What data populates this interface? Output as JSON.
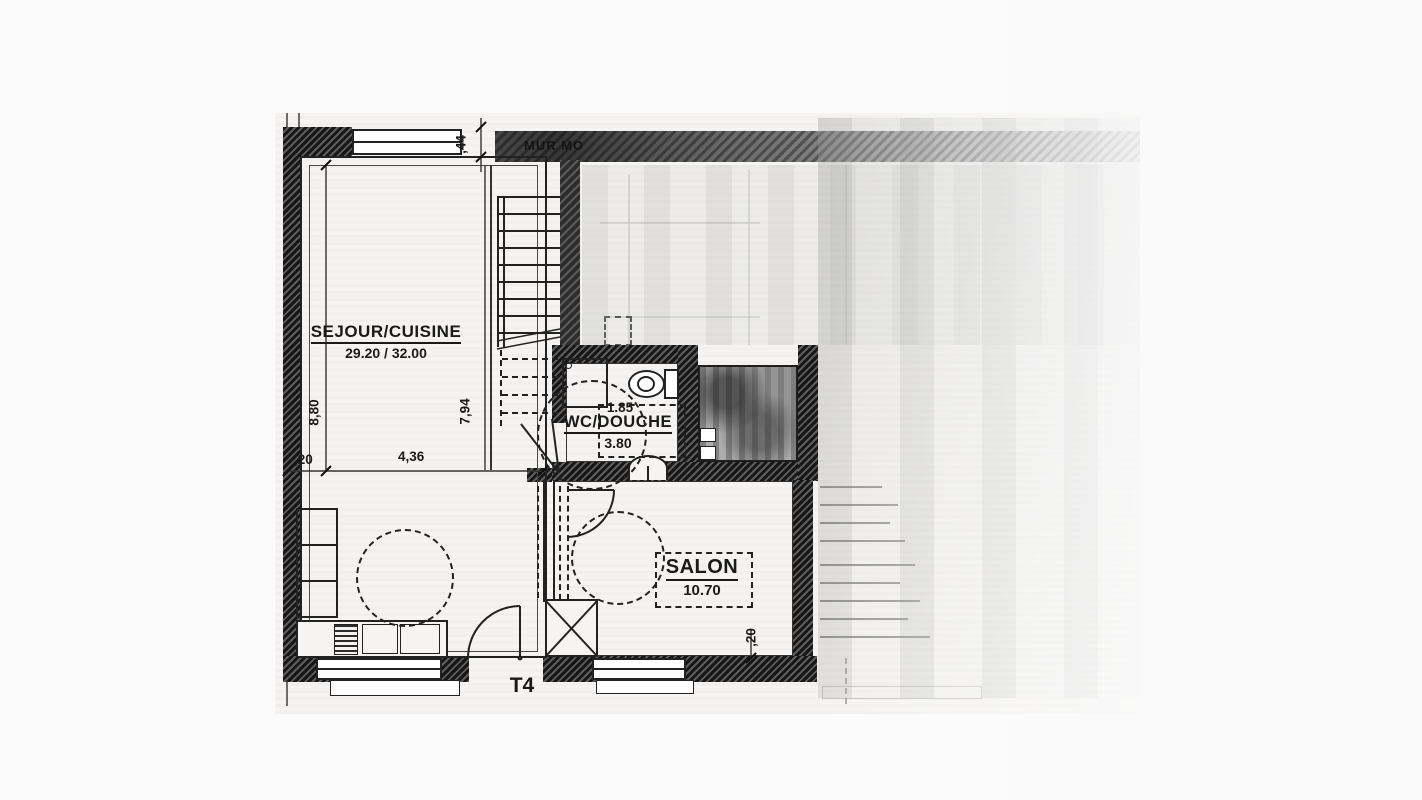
{
  "plan": {
    "type_label": "T4",
    "wall_label": "MUR MO",
    "rooms": {
      "sejour": {
        "name": "SEJOUR/CUISINE",
        "area": "29.20 / 32.00"
      },
      "wc": {
        "name": "WC/DOUCHE",
        "width": "1.85",
        "area": "3.80"
      },
      "salon": {
        "name": "SALON",
        "area": "10.70"
      }
    },
    "dimensions": {
      "top_offset": ",44",
      "sejour_height": "8,80",
      "wall_thickness": ",20",
      "sejour_width": "4,36",
      "stair_depth": "7,94",
      "salon_wall": ",20"
    },
    "colors": {
      "wall": "#1e1e1e",
      "line": "#2a2a2a",
      "paper": "#f5f4f2"
    }
  }
}
